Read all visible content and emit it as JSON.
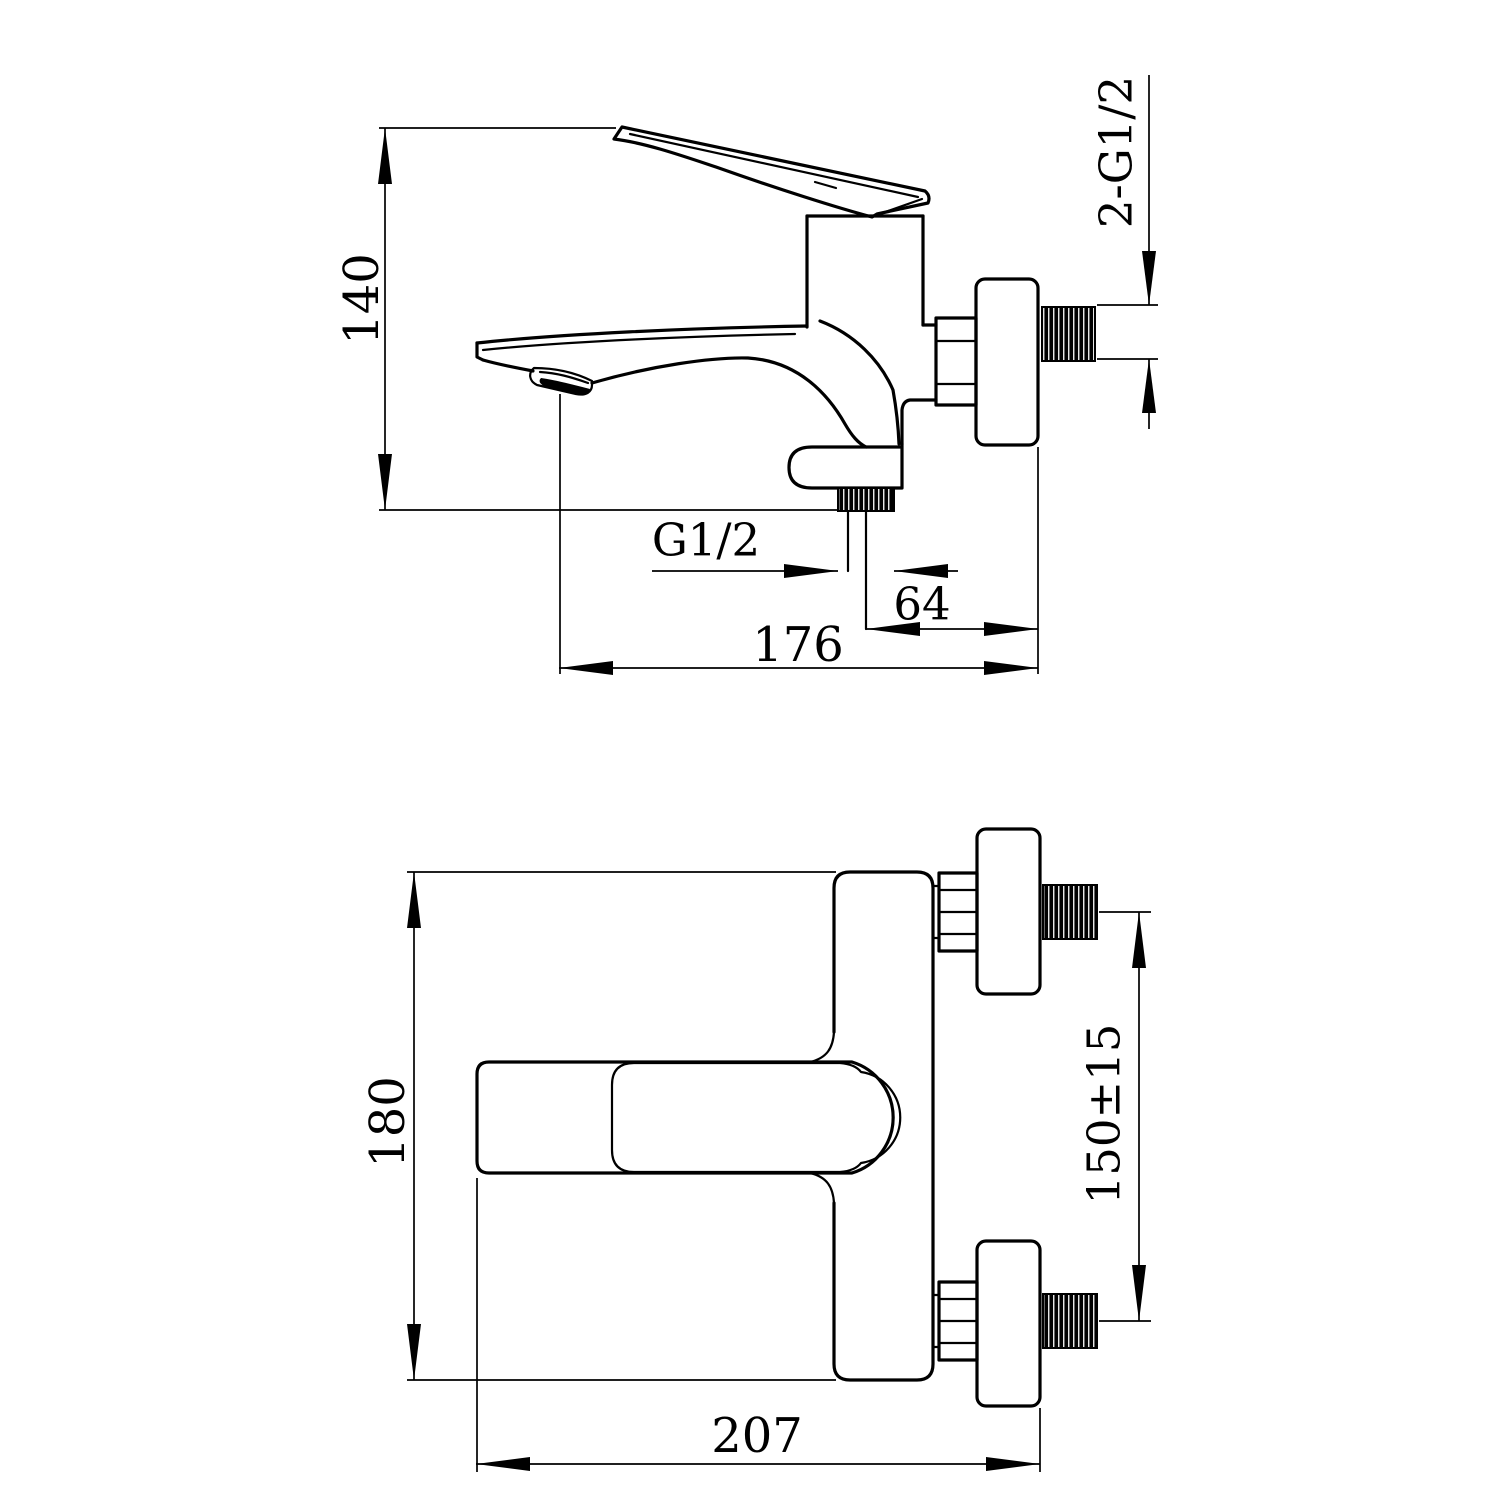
{
  "page": {
    "type": "technical-drawing",
    "subject": "wall-mounted bath shower mixer faucet, two orthographic views",
    "colors": {
      "ink": "#000000",
      "paper": "#ffffff"
    }
  },
  "dimensions": {
    "side_height": "140",
    "side_wall_threads": "2-G1/2",
    "side_outlet_thread": "G1/2",
    "side_outlet_to_wall": "64",
    "side_spout_reach": "176",
    "front_height": "180",
    "front_hole_centers": "150±15",
    "front_width": "207"
  }
}
